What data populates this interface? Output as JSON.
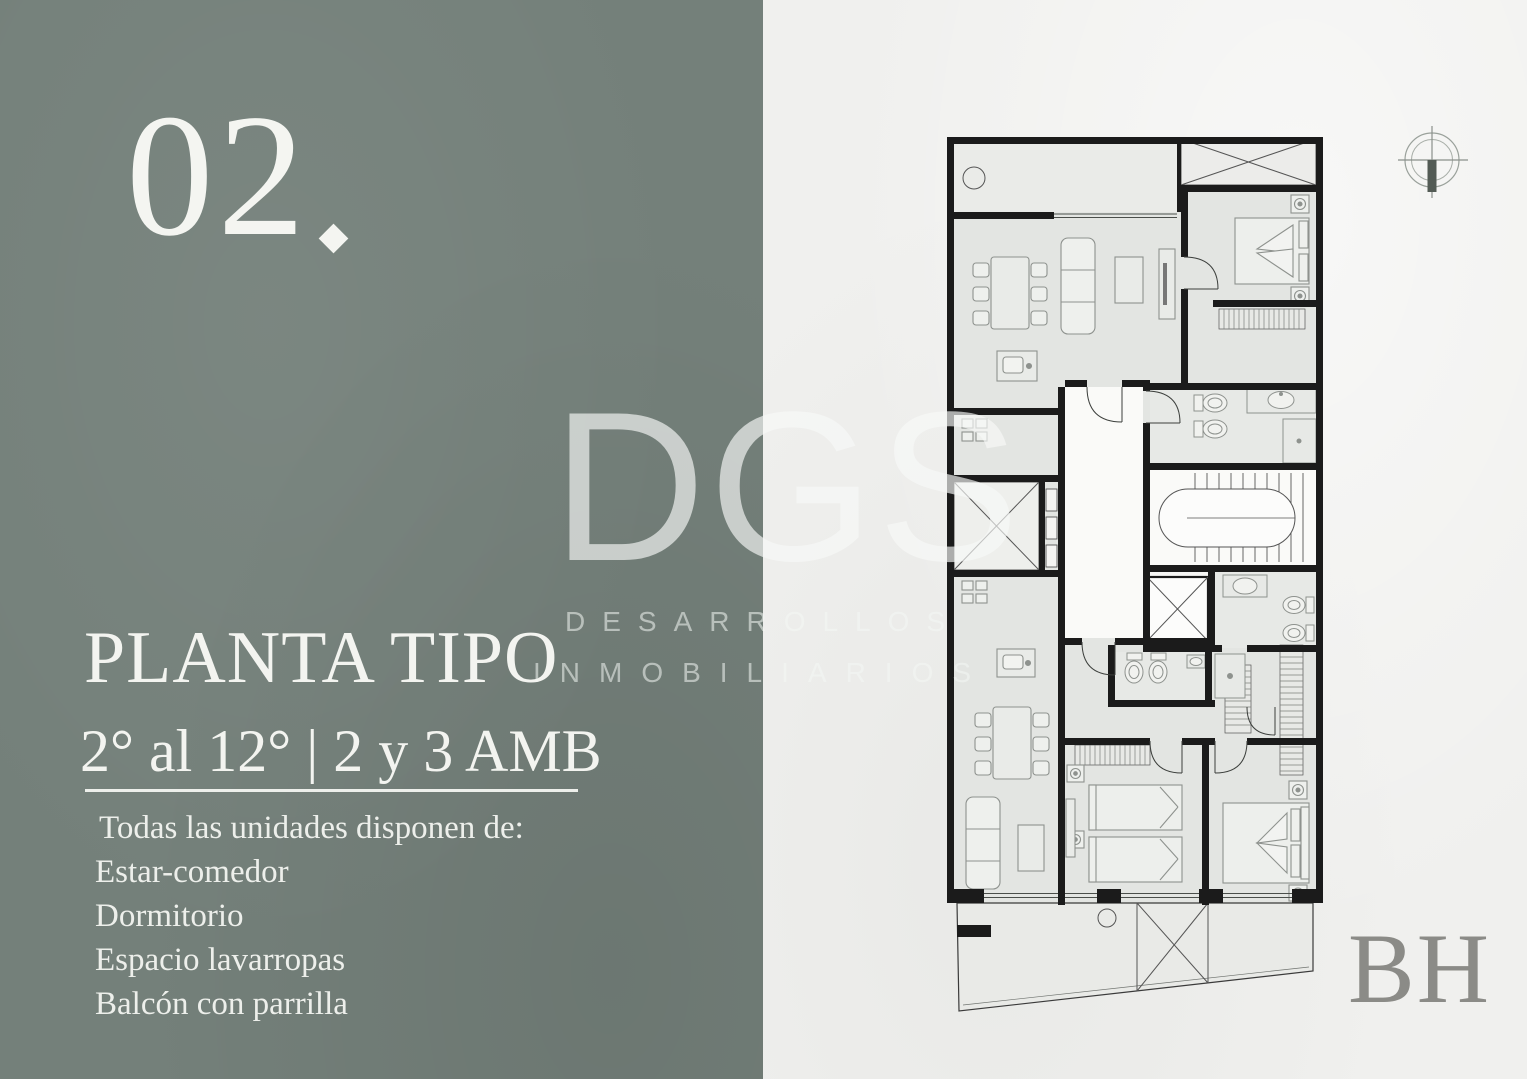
{
  "slide": {
    "number": "02",
    "number_dot": ".",
    "title": "PLANTA TIPO",
    "subtitle": "2° al 12° | 2 y 3 AMB",
    "features_intro": "Todas las unidades disponen de:",
    "features": [
      "Estar-comedor",
      "Dormitorio",
      "Espacio lavarropas",
      "Balcón con parrilla"
    ]
  },
  "watermark": {
    "logo": "DGS",
    "line1": "DESARROLLOS",
    "line2": "INMOBILIARIOS"
  },
  "brand": {
    "initials": "BH"
  },
  "colors": {
    "panel_green": "#74807a",
    "paper": "#f0f0ee",
    "wall_ink": "#1b1b1b",
    "room_fill": "#e3e5e2",
    "text_on_panel": "#f3f4f0",
    "brand_gray": "#8b8b87",
    "watermark_white": "rgba(247,249,247,0.66)"
  },
  "floor_plan": {
    "compass_icon": "north-compass-icon",
    "elements": [
      "balcony-top",
      "air-shaft-x",
      "bedroom-top",
      "living-dining-top",
      "kitchen-top",
      "void-x",
      "corridor",
      "bathrooms",
      "staircase",
      "elevator-x",
      "kitchen-bottom",
      "living-dining-bottom",
      "twin-bedroom",
      "bedroom-bottom",
      "balcony-bottom-x"
    ]
  }
}
